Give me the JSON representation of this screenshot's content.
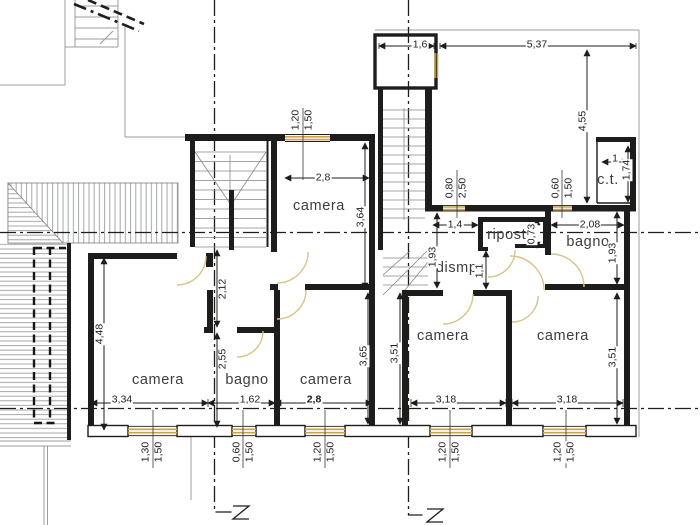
{
  "drawing": {
    "colors": {
      "wall": "#1d1d1b",
      "window_frame": "#c9a44a",
      "door_arc": "#d8c489",
      "hatch_line": "#98a098",
      "axis": "#1d1d1b",
      "label_text": "#3d3d3c"
    },
    "room_labels": [
      {
        "t": "camera",
        "x": 319,
        "y": 206
      },
      {
        "t": "camera",
        "x": 158,
        "y": 380
      },
      {
        "t": "bagno",
        "x": 247,
        "y": 380
      },
      {
        "t": "camera",
        "x": 326,
        "y": 380
      },
      {
        "t": "camera",
        "x": 443,
        "y": 336
      },
      {
        "t": "camera",
        "x": 563,
        "y": 336
      },
      {
        "t": "bagno",
        "x": 588,
        "y": 242
      },
      {
        "t": "ripost.",
        "x": 509,
        "y": 235
      },
      {
        "t": "dismp.",
        "x": 459,
        "y": 268
      },
      {
        "t": "c.t.",
        "x": 608,
        "y": 180
      }
    ],
    "dim_labels": [
      {
        "t": "1,6",
        "x": 420,
        "y": 45
      },
      {
        "t": "5,37",
        "x": 537,
        "y": 45
      },
      {
        "t": "4,55",
        "x": 583,
        "y": 121,
        "r": 1
      },
      {
        "t": "1",
        "x": 615,
        "y": 159
      },
      {
        "t": "1,74",
        "x": 627,
        "y": 170,
        "r": 1
      },
      {
        "t": "1,20",
        "x": 296,
        "y": 120,
        "r": 1
      },
      {
        "t": "1,50",
        "x": 309,
        "y": 120,
        "r": 1
      },
      {
        "t": "2,8",
        "x": 323,
        "y": 178
      },
      {
        "t": "3,64",
        "x": 361,
        "y": 217,
        "r": 1
      },
      {
        "t": "0,80",
        "x": 450,
        "y": 188,
        "r": 1
      },
      {
        "t": "2,50",
        "x": 463,
        "y": 188,
        "r": 1
      },
      {
        "t": "0,60",
        "x": 556,
        "y": 188,
        "r": 1
      },
      {
        "t": "1,50",
        "x": 569,
        "y": 188,
        "r": 1
      },
      {
        "t": "1,4",
        "x": 455,
        "y": 225
      },
      {
        "t": "0,73",
        "x": 532,
        "y": 234,
        "r": 1
      },
      {
        "t": "2,08",
        "x": 590,
        "y": 225
      },
      {
        "t": "1,93",
        "x": 433,
        "y": 257,
        "r": 1
      },
      {
        "t": "1,93",
        "x": 613,
        "y": 253,
        "r": 1
      },
      {
        "t": "1,1",
        "x": 480,
        "y": 271,
        "r": 1
      },
      {
        "t": "2,12",
        "x": 223,
        "y": 289,
        "r": 1
      },
      {
        "t": "4,48",
        "x": 100,
        "y": 334,
        "r": 1
      },
      {
        "t": "2,55",
        "x": 223,
        "y": 359,
        "r": 1
      },
      {
        "t": "3,65",
        "x": 364,
        "y": 356,
        "r": 1
      },
      {
        "t": "3,51",
        "x": 395,
        "y": 353,
        "r": 1
      },
      {
        "t": "3,51",
        "x": 613,
        "y": 357,
        "r": 1
      },
      {
        "t": "3,34",
        "x": 122,
        "y": 400
      },
      {
        "t": "1,62",
        "x": 250,
        "y": 400
      },
      {
        "t": "2,8",
        "x": 314,
        "y": 400,
        "b": 1
      },
      {
        "t": "3,18",
        "x": 446,
        "y": 400
      },
      {
        "t": "3,18",
        "x": 567,
        "y": 400
      },
      {
        "t": "1,30",
        "x": 146,
        "y": 452,
        "r": 1
      },
      {
        "t": "1,50",
        "x": 159,
        "y": 452,
        "r": 1
      },
      {
        "t": "0,60",
        "x": 237,
        "y": 452,
        "r": 1
      },
      {
        "t": "1,50",
        "x": 250,
        "y": 452,
        "r": 1
      },
      {
        "t": "1,20",
        "x": 318,
        "y": 452,
        "r": 1
      },
      {
        "t": "1,50",
        "x": 331,
        "y": 452,
        "r": 1
      },
      {
        "t": "1,20",
        "x": 443,
        "y": 452,
        "r": 1
      },
      {
        "t": "1,50",
        "x": 456,
        "y": 452,
        "r": 1
      },
      {
        "t": "1,20",
        "x": 558,
        "y": 452,
        "r": 1
      },
      {
        "t": "1,50",
        "x": 571,
        "y": 452,
        "r": 1
      }
    ]
  }
}
